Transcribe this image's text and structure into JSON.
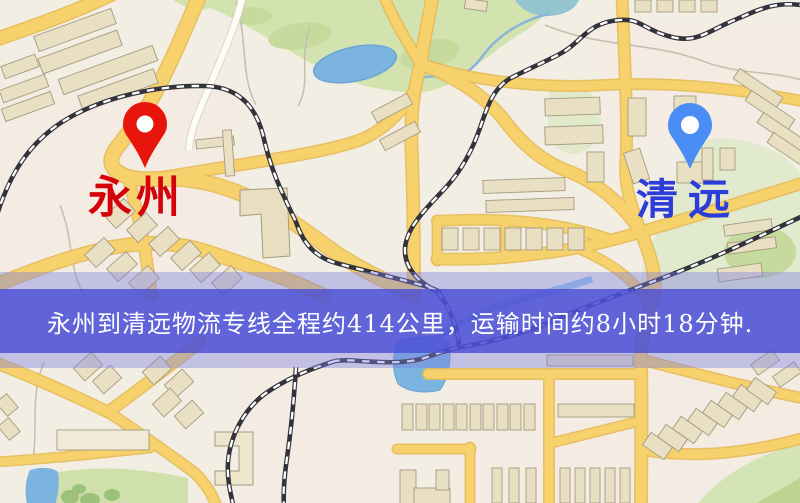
{
  "page": {
    "type": "logistics-route-map",
    "width": 800,
    "height": 503
  },
  "markers": [
    {
      "city": "永州",
      "role": "origin",
      "pin_color": "#e8150d",
      "pin_stroke": "#c50d06",
      "label_color": "#d50309"
    },
    {
      "city": "清远",
      "role": "destination",
      "pin_color": "#4a8df5",
      "pin_stroke": "#2f6fd8",
      "label_color": "#2b3cd8"
    }
  ],
  "banner": {
    "text": "永州到清远物流专线全程约414公里，运输时间约8小时18分钟.",
    "bg_color": "#484cd5",
    "text_color": "#ffffff"
  },
  "route": {
    "origin": "永州",
    "destination": "清远",
    "distance": "约414公里",
    "duration": "约8小时18分钟"
  }
}
